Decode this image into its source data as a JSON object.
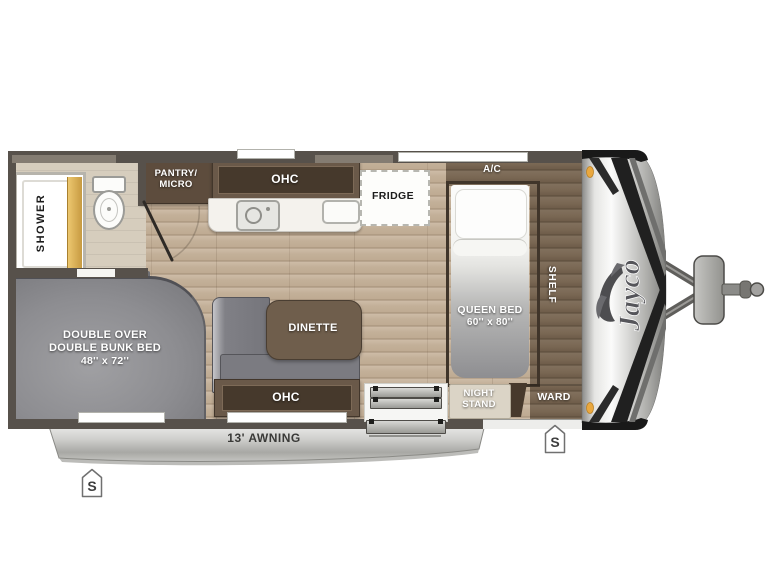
{
  "floorplan": {
    "brand_logo": "Jayco",
    "awning_label": "13' AWNING",
    "speaker_marker": "S",
    "bathroom": {
      "shower": "SHOWER"
    },
    "kitchen": {
      "pantry_line1": "PANTRY/",
      "pantry_line2": "MICRO",
      "ohc": "OHC",
      "fridge": "FRIDGE"
    },
    "bedroom": {
      "ac": "A/C",
      "bed_line1": "QUEEN BED",
      "bed_line2": "60'' x 80''",
      "shelf": "SHELF",
      "night_stand_line1": "NIGHT",
      "night_stand_line2": "STAND",
      "ward": "WARD"
    },
    "living": {
      "dinette": "DINETTE",
      "ohc": "OHC",
      "bunk_line1": "DOUBLE OVER",
      "bunk_line2": "DOUBLE BUNK BED",
      "bunk_line3": "48'' x 72''"
    },
    "colors": {
      "wall": "#57514b",
      "floor_wood": "#c2ae97",
      "platform_wood": "#7a6854",
      "cabinet_dark": "#5d4c3d",
      "cabinet_panel": "#46392c",
      "upholstery": "#8c8c90",
      "awning_silver": "#c9c9c9",
      "marker_amber": "#e8a33d"
    }
  }
}
